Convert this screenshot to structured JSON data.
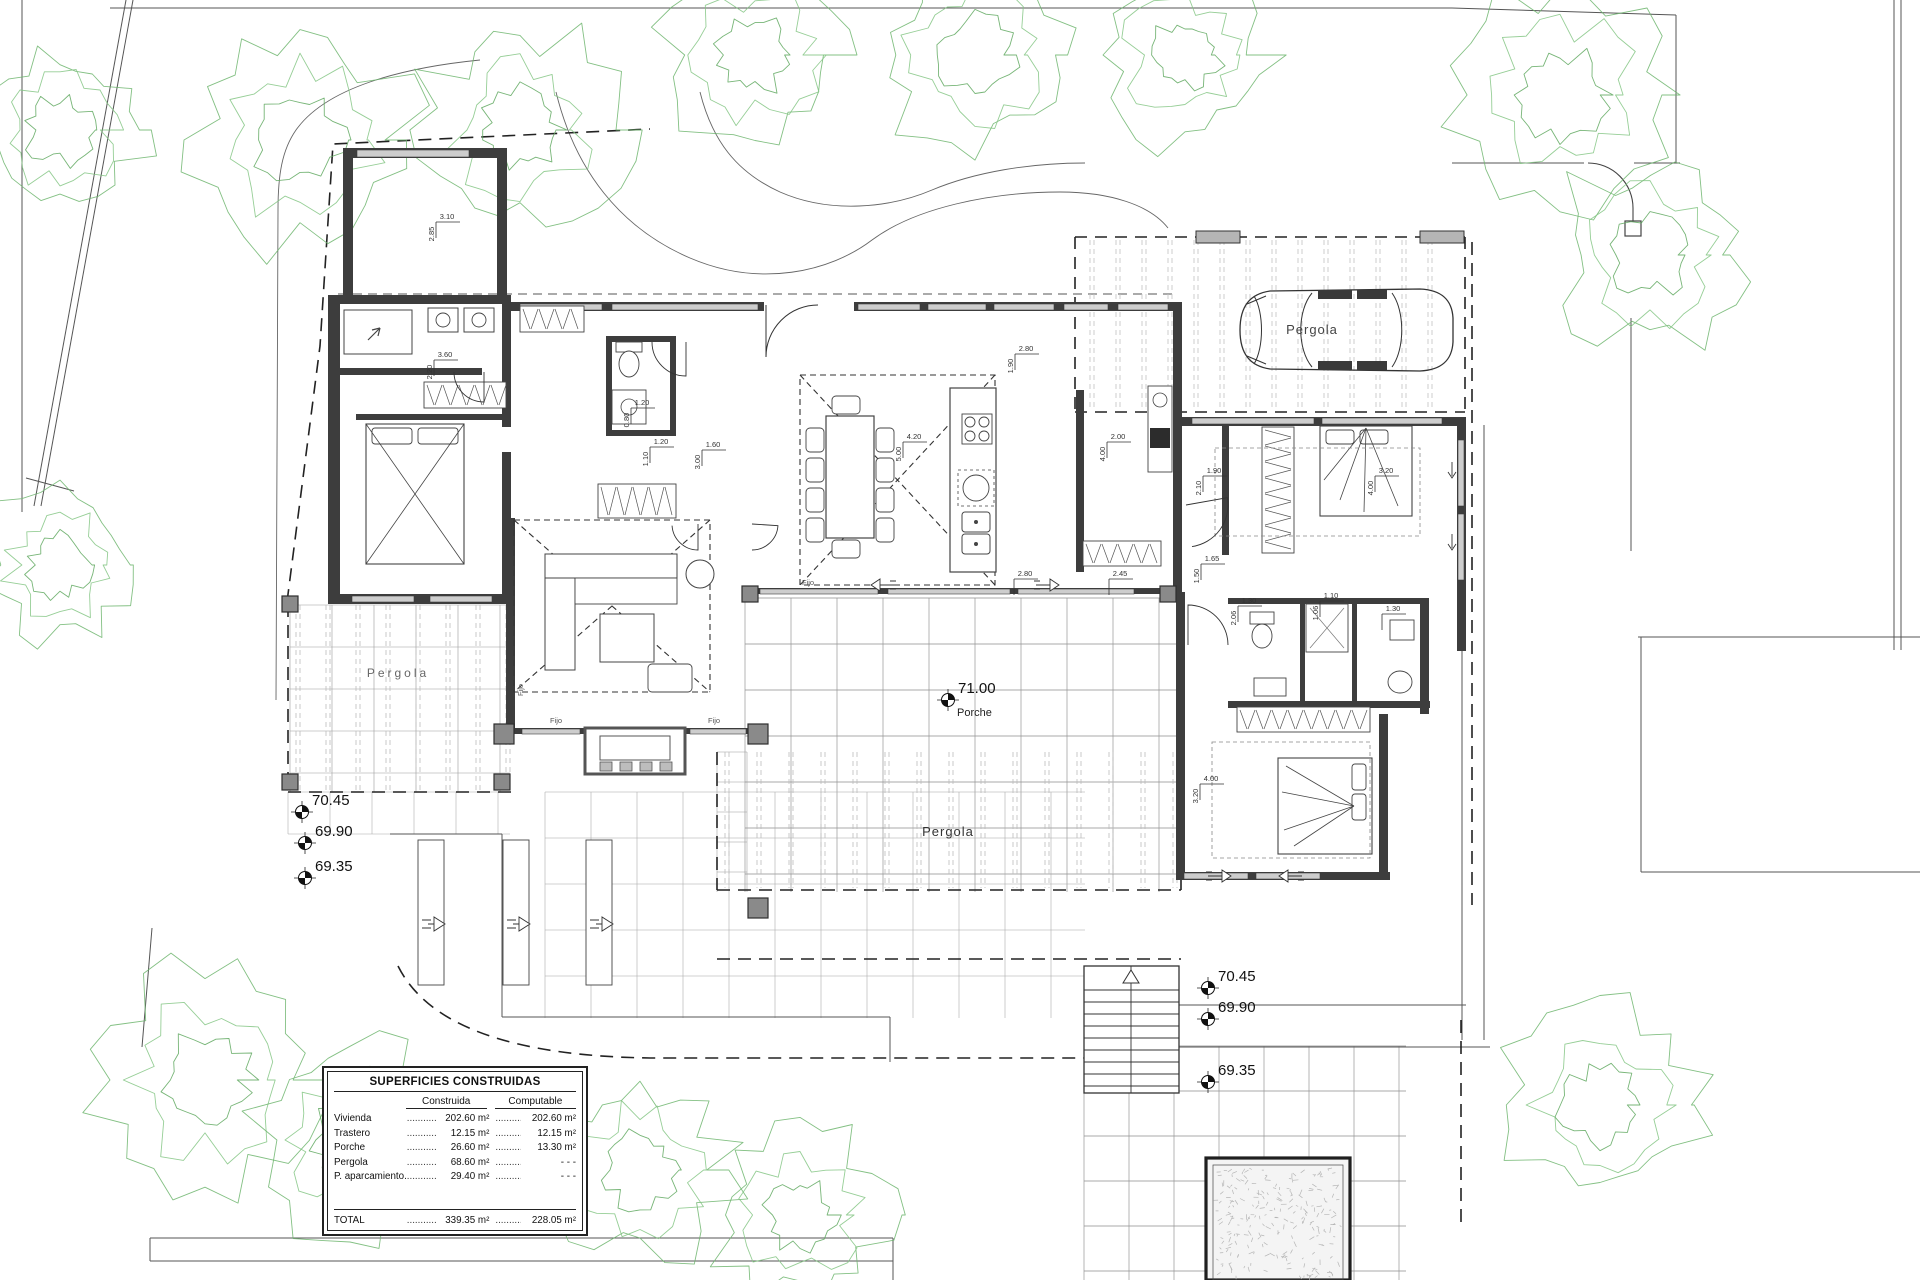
{
  "plan": {
    "pergola_labels": [
      {
        "id": "pergola-carport",
        "text": "Pergola",
        "x": 1312,
        "y": 334,
        "size": 13,
        "ls": 1,
        "color": "#444"
      },
      {
        "id": "pergola-left",
        "text": "Pergola",
        "x": 398,
        "y": 677,
        "size": 12,
        "ls": 3,
        "color": "#666"
      },
      {
        "id": "pergola-bottom",
        "text": "Pergola",
        "x": 948,
        "y": 836,
        "size": 13,
        "ls": 1,
        "color": "#333"
      }
    ],
    "fijo_text": "Fijo",
    "fijo_positions": [
      {
        "x": 556,
        "y": 723,
        "rot": 0
      },
      {
        "x": 714,
        "y": 723,
        "rot": 0
      },
      {
        "x": 808,
        "y": 585,
        "rot": 0
      },
      {
        "x": 523,
        "y": 690,
        "rot": -90
      }
    ],
    "elevation_markers": [
      {
        "value": "70.45",
        "x": 302,
        "y": 812
      },
      {
        "value": "69.90",
        "x": 305,
        "y": 843
      },
      {
        "value": "69.35",
        "x": 305,
        "y": 878
      },
      {
        "value": "70.45",
        "x": 1208,
        "y": 988
      },
      {
        "value": "69.90",
        "x": 1208,
        "y": 1019
      },
      {
        "value": "69.35",
        "x": 1208,
        "y": 1082
      },
      {
        "value": "71.00",
        "x": 948,
        "y": 700,
        "sublabel": "Porche"
      }
    ],
    "dimensions": [
      {
        "x": 447,
        "y": 219,
        "text": "3.10",
        "o": "h"
      },
      {
        "x": 434,
        "y": 234,
        "text": "2.85",
        "o": "v"
      },
      {
        "x": 445,
        "y": 357,
        "text": "3.60",
        "o": "h"
      },
      {
        "x": 432,
        "y": 372,
        "text": "2.20",
        "o": "v"
      },
      {
        "x": 914,
        "y": 439,
        "text": "4.20",
        "o": "h"
      },
      {
        "x": 901,
        "y": 454,
        "text": "5.00",
        "o": "v"
      },
      {
        "x": 1026,
        "y": 351,
        "text": "2.80",
        "o": "h"
      },
      {
        "x": 1013,
        "y": 366,
        "text": "1.90",
        "o": "v"
      },
      {
        "x": 1118,
        "y": 439,
        "text": "2.00",
        "o": "h"
      },
      {
        "x": 1105,
        "y": 454,
        "text": "4.00",
        "o": "v"
      },
      {
        "x": 1025,
        "y": 576,
        "text": "2.80",
        "o": "h"
      },
      {
        "x": 1120,
        "y": 576,
        "text": "2.45",
        "o": "h"
      },
      {
        "x": 661,
        "y": 444,
        "text": "1.20",
        "o": "h"
      },
      {
        "x": 648,
        "y": 459,
        "text": "1.10",
        "o": "v"
      },
      {
        "x": 713,
        "y": 447,
        "text": "1.60",
        "o": "h"
      },
      {
        "x": 700,
        "y": 462,
        "text": "3.00",
        "o": "v"
      },
      {
        "x": 642,
        "y": 405,
        "text": "1.20",
        "o": "h"
      },
      {
        "x": 629,
        "y": 420,
        "text": "0.80",
        "o": "v"
      },
      {
        "x": 1214,
        "y": 473,
        "text": "1.90",
        "o": "h"
      },
      {
        "x": 1201,
        "y": 488,
        "text": "2.10",
        "o": "v"
      },
      {
        "x": 1386,
        "y": 473,
        "text": "3.20",
        "o": "h"
      },
      {
        "x": 1373,
        "y": 488,
        "text": "4.00",
        "o": "v"
      },
      {
        "x": 1212,
        "y": 561,
        "text": "1.65",
        "o": "h"
      },
      {
        "x": 1199,
        "y": 576,
        "text": "1.50",
        "o": "v"
      },
      {
        "x": 1249,
        "y": 603,
        "text": "1.30",
        "o": "h"
      },
      {
        "x": 1236,
        "y": 618,
        "text": "2.06",
        "o": "v"
      },
      {
        "x": 1331,
        "y": 598,
        "text": "1.10",
        "o": "h"
      },
      {
        "x": 1318,
        "y": 613,
        "text": "1.06",
        "o": "v"
      },
      {
        "x": 1393,
        "y": 611,
        "text": "1.30",
        "o": "h"
      },
      {
        "x": 1211,
        "y": 781,
        "text": "4.00",
        "o": "h"
      },
      {
        "x": 1198,
        "y": 796,
        "text": "3.20",
        "o": "v"
      }
    ]
  },
  "areas_table": {
    "title": "SUPERFICIES CONSTRUIDAS",
    "columns": [
      "Construida",
      "Computable"
    ],
    "rows": [
      {
        "name": "Vivienda",
        "construida": "202.60 m²",
        "computable": "202.60 m²"
      },
      {
        "name": "Trastero",
        "construida": "12.15 m²",
        "computable": "12.15 m²"
      },
      {
        "name": "Porche",
        "construida": "26.60 m²",
        "computable": "13.30 m²"
      },
      {
        "name": "Pergola",
        "construida": "68.60 m²",
        "computable": "- - -"
      },
      {
        "name": "P. aparcamiento...",
        "construida": "29.40 m²",
        "computable": "- - -"
      }
    ],
    "total": {
      "name": "TOTAL",
      "construida": "339.35 m²",
      "computable": "228.05 m²"
    },
    "leader_dots": "............"
  }
}
